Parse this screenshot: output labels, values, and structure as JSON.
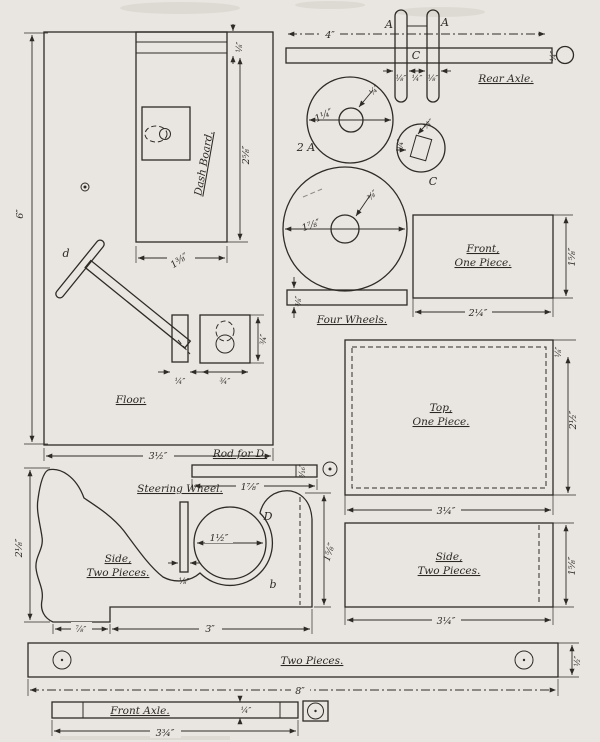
{
  "palette": {
    "paper": "#e9e6e1",
    "ink": "#2e2b27"
  },
  "floor": {
    "label": "Floor.",
    "part_d_label": "d",
    "height_dim": "6″",
    "width_dim": "3½″",
    "strip_dim": "⅛″",
    "dashboard": {
      "label": "Dash Board.",
      "height_dim": "2⅝″",
      "width_dim": "1⅜″"
    },
    "post_dim": "¼″",
    "slot_width_dim": "¾″",
    "slot_height_dim": "¾″"
  },
  "rear_axle": {
    "label": "Rear Axle.",
    "length_dim": "4″",
    "disc_left_label": "A",
    "disc_right_label": "A",
    "hub_label": "C",
    "disc_left_dim": "⅛″",
    "gap_dim": "¼″",
    "disc_right_dim": "⅛″",
    "end_dim": "¼″"
  },
  "wheels": {
    "label": "Four Wheels.",
    "small_wheel": {
      "label": "2 A",
      "diameter_dim": "1¼″",
      "hub_dim": "¼″"
    },
    "c_wheel": {
      "label": "C",
      "square_dim_top": "¼″",
      "square_dim_side": "¼″"
    },
    "large_wheel": {
      "diameter_dim": "1⅞″",
      "hub_dim": "⅜″"
    },
    "strip_dim": "⅜″"
  },
  "front_piece": {
    "label_line1": "Front,",
    "label_line2": "One Piece.",
    "width_dim": "2¼″",
    "height_dim": "1⅝″"
  },
  "top_piece": {
    "label_line1": "Top,",
    "label_line2": "One Piece.",
    "width_dim": "3¼″",
    "height_dim": "2½″",
    "margin_dim": "⅛″"
  },
  "side_piece": {
    "label_line1": "Side,",
    "label_line2": "Two Pieces.",
    "width_dim": "3¼″",
    "height_dim": "1⅝″"
  },
  "side_profile": {
    "label_line1": "Side,",
    "label_line2": "Two Pieces.",
    "height_dim": "2⅛″",
    "front_bottom_dim": "⅞″",
    "bottom_dim": "3″",
    "rear_height_dim": "1⅝″",
    "point_label": "b"
  },
  "steering_wheel": {
    "label": "Steering Wheel.",
    "wheel_label": "D",
    "diameter_dim": "1½″",
    "thickness_dim": "⅛″"
  },
  "rod": {
    "label": "Rod for D.",
    "length_dim": "1⅞″",
    "thickness_dim": "³⁄₁₆″"
  },
  "runner": {
    "label": "Two Pieces.",
    "length_dim": "8″",
    "height_dim": "½″"
  },
  "front_axle": {
    "label": "Front Axle.",
    "length_dim": "3¾″",
    "notch_dim": "¼″"
  }
}
